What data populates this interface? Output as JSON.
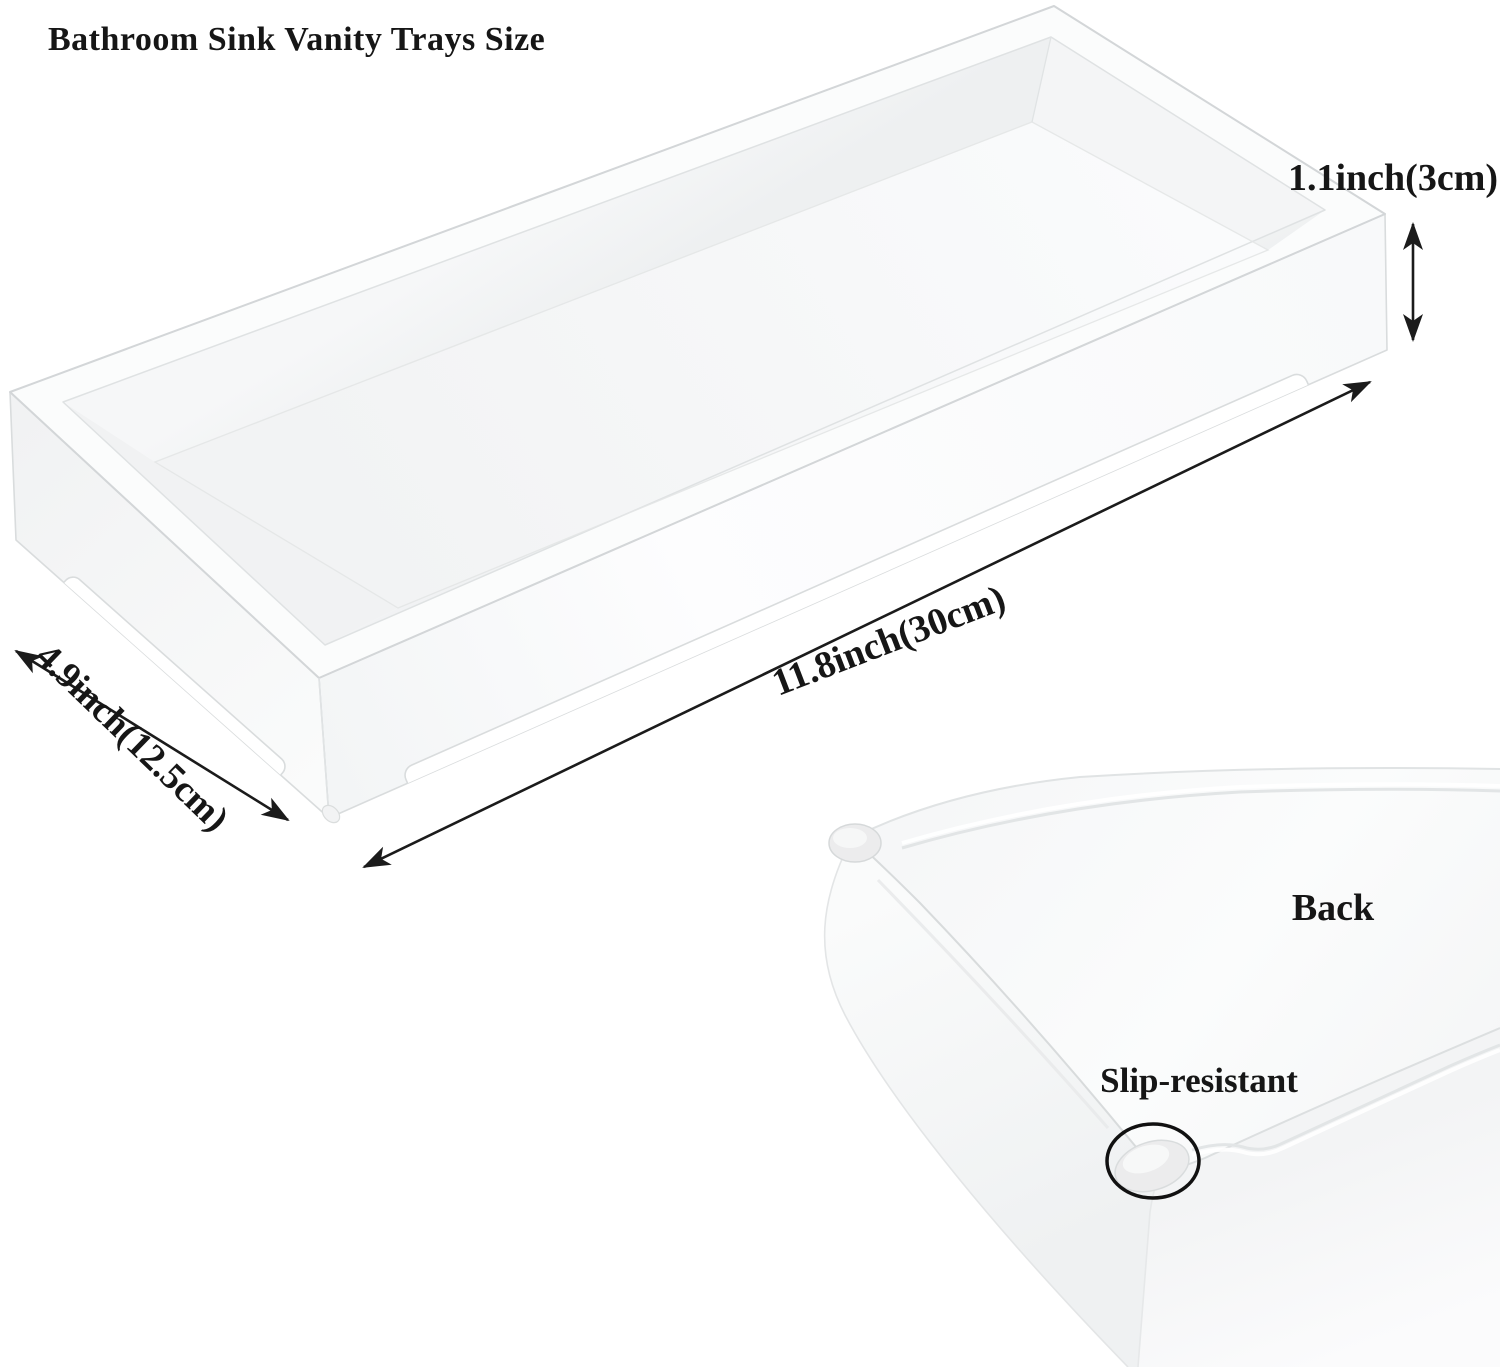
{
  "title": "Bathroom Sink Vanity Trays Size",
  "dimensions": {
    "height": {
      "label": "1.1inch(3cm)"
    },
    "length": {
      "label": "11.8inch(30cm)"
    },
    "width": {
      "label": "4.9inch(12.5cm)"
    }
  },
  "back_view": {
    "label": "Back",
    "feature": "Slip-resistant"
  },
  "colors": {
    "ink": "#1b1b1b",
    "background": "#ffffff",
    "tray_surface": "#f7f8f9",
    "edge_gray": "#d6d9da",
    "annotation_circle": "#111111"
  }
}
